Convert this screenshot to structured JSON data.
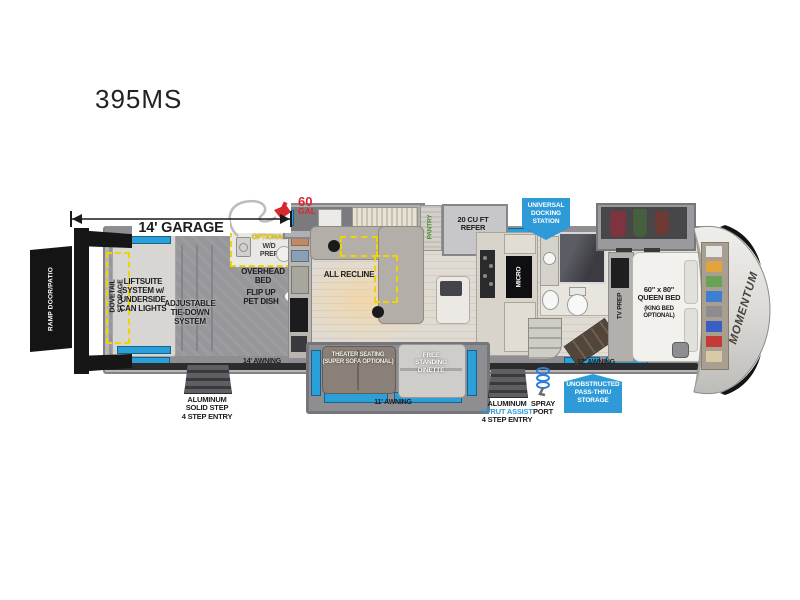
{
  "title": "395MS",
  "dims": {
    "garage": "14' GARAGE"
  },
  "fuel": {
    "amount": "60",
    "unit": "GAL"
  },
  "palette": {
    "accent_blue": "#2e9bd8",
    "highlight_yellow": "#eed500",
    "red": "#d7282f"
  },
  "exterior": {
    "ramp_door": "RAMP DOOR/PATIO",
    "awning_rear": "14' AWNING",
    "awning_mid": "11' AWNING",
    "awning_front": "12' AWNING",
    "steps_rear": "ALUMINUM\nSOLID STEP\n4 STEP ENTRY",
    "steps_main_1": "ALUMINUM",
    "steps_main_2": "STRUT ASSIST",
    "steps_main_3": "4 STEP ENTRY",
    "spray_port": "SPRAY\nPORT",
    "badge_docking": "UNIVERSAL\nDOCKING\nSTATION",
    "badge_passthru": "UNOBSTRUCTED\nPASS-THRU\nSTORAGE",
    "brand": "MOMENTUM"
  },
  "garage": {
    "dovetail": "DOVETAIL\nSTORAGE",
    "liftsuite": "LIFTSUITE\nSYSTEM w/\nUNDERSIDE\nCAN LIGHTS",
    "tie_down": "ADJUSTABLE\nTIE-DOWN\nSYSTEM",
    "optional": "OPTIONAL",
    "wd_prep": "W/D\nPREP",
    "overhead_bed": "OVERHEAD\nBED",
    "pet_dish": "FLIP UP\nPET DISH"
  },
  "living": {
    "all_recline": "ALL RECLINE",
    "pantry": "PANTRY",
    "refer": "20 CU FT\nREFER",
    "micro": "MICRO",
    "theater": "THEATER SEATING\n(SUPER SOFA OPTIONAL)",
    "dinette": "FREE\nSTANDING\nDINETTE"
  },
  "bedroom": {
    "tv_prep": "TV PREP",
    "bed": "60\" x 80\"\nQUEEN BED",
    "bed_option": "(KING BED\nOPTIONAL)"
  }
}
